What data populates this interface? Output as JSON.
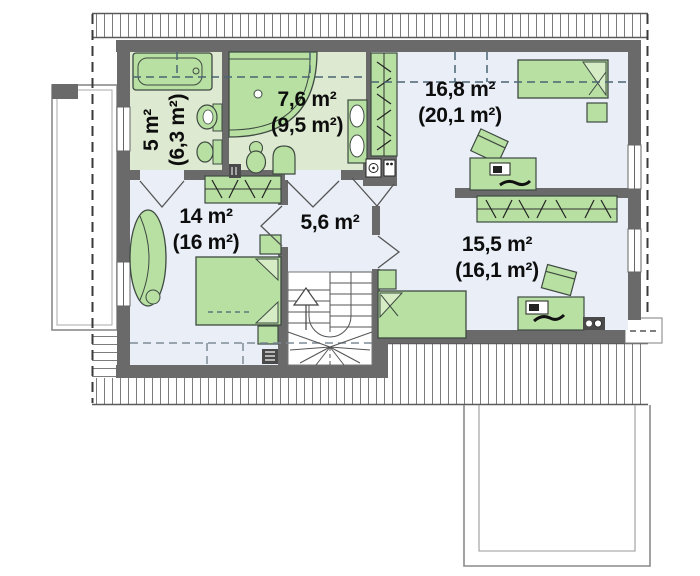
{
  "plan_title": "Attic floor plan",
  "rooms": {
    "bathroom_small": {
      "area": "5 m²",
      "gross": "(6,3 m²)"
    },
    "bathroom_main": {
      "area": "7,6 m²",
      "gross": "(9,5 m²)"
    },
    "bedroom_ne": {
      "area": "16,8 m²",
      "gross": "(20,1 m²)"
    },
    "bedroom_w": {
      "area": "14 m²",
      "gross": "(16 m²)"
    },
    "hallway": {
      "area": "5,6 m²"
    },
    "bedroom_se": {
      "area": "15,5 m²",
      "gross": "(16,1 m²)"
    }
  },
  "icons": [
    "bathtub-icon",
    "corner-bathtub-icon",
    "toilet-icon",
    "washbasin-icon",
    "double-washbasin-icon",
    "washing-machine-icon",
    "bed-icon",
    "double-bed-icon",
    "nightstand-icon",
    "wardrobe-icon",
    "desk-icon",
    "laptop-icon",
    "chair-icon",
    "armchair-icon",
    "stairs-icon",
    "up-arrow-icon",
    "radiator-icon",
    "speaker-icon",
    "window-icon",
    "door-icon",
    "balcony",
    "garage-roof-outline",
    "roof-hatch"
  ],
  "colors": {
    "wall": "#6a6a6a",
    "bath_floor": "#dde9d1",
    "room_floor": "#e9eef7",
    "furniture": "#b7e0a2",
    "furniture_outline": "#3f4a42",
    "roof_hatch_line": "#7d7d7d",
    "knee_dash": "#4a6572",
    "text": "#0d0d0d"
  }
}
